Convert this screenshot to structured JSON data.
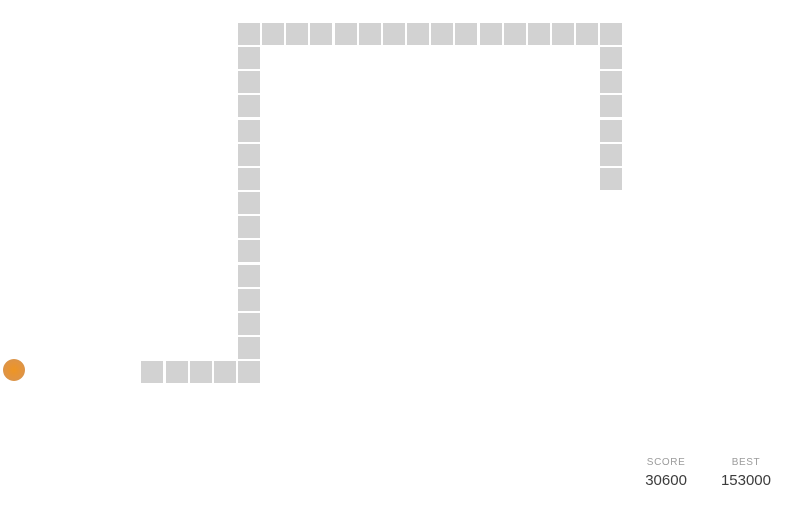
{
  "game": {
    "grid": {
      "origin_x": 238,
      "origin_y": 23,
      "pitch": 24.15,
      "cell_size": 22
    },
    "snake": {
      "color": "#d2d2d2",
      "length": 40,
      "segments": [
        [
          -4,
          14
        ],
        [
          -3,
          14
        ],
        [
          -2,
          14
        ],
        [
          -1,
          14
        ],
        [
          0,
          14
        ],
        [
          0,
          13
        ],
        [
          0,
          12
        ],
        [
          0,
          11
        ],
        [
          0,
          10
        ],
        [
          0,
          9
        ],
        [
          0,
          8
        ],
        [
          0,
          7
        ],
        [
          0,
          6
        ],
        [
          0,
          5
        ],
        [
          0,
          4
        ],
        [
          0,
          3
        ],
        [
          0,
          2
        ],
        [
          0,
          1
        ],
        [
          0,
          0
        ],
        [
          1,
          0
        ],
        [
          2,
          0
        ],
        [
          3,
          0
        ],
        [
          4,
          0
        ],
        [
          5,
          0
        ],
        [
          6,
          0
        ],
        [
          7,
          0
        ],
        [
          8,
          0
        ],
        [
          9,
          0
        ],
        [
          10,
          0
        ],
        [
          11,
          0
        ],
        [
          12,
          0
        ],
        [
          13,
          0
        ],
        [
          14,
          0
        ],
        [
          15,
          0
        ],
        [
          15,
          1
        ],
        [
          15,
          2
        ],
        [
          15,
          3
        ],
        [
          15,
          4
        ],
        [
          15,
          5
        ],
        [
          15,
          6
        ]
      ]
    },
    "food": {
      "x": 3,
      "y": 359,
      "diameter": 22,
      "color_center": "#ee9522",
      "color_edge": "#ca9157"
    }
  },
  "scoreboard": {
    "score_label": "SCORE",
    "score_value": "30600",
    "best_label": "BEST",
    "best_value": "153000",
    "label_color": "#9b9b9b",
    "value_color": "#3c3c3c"
  }
}
